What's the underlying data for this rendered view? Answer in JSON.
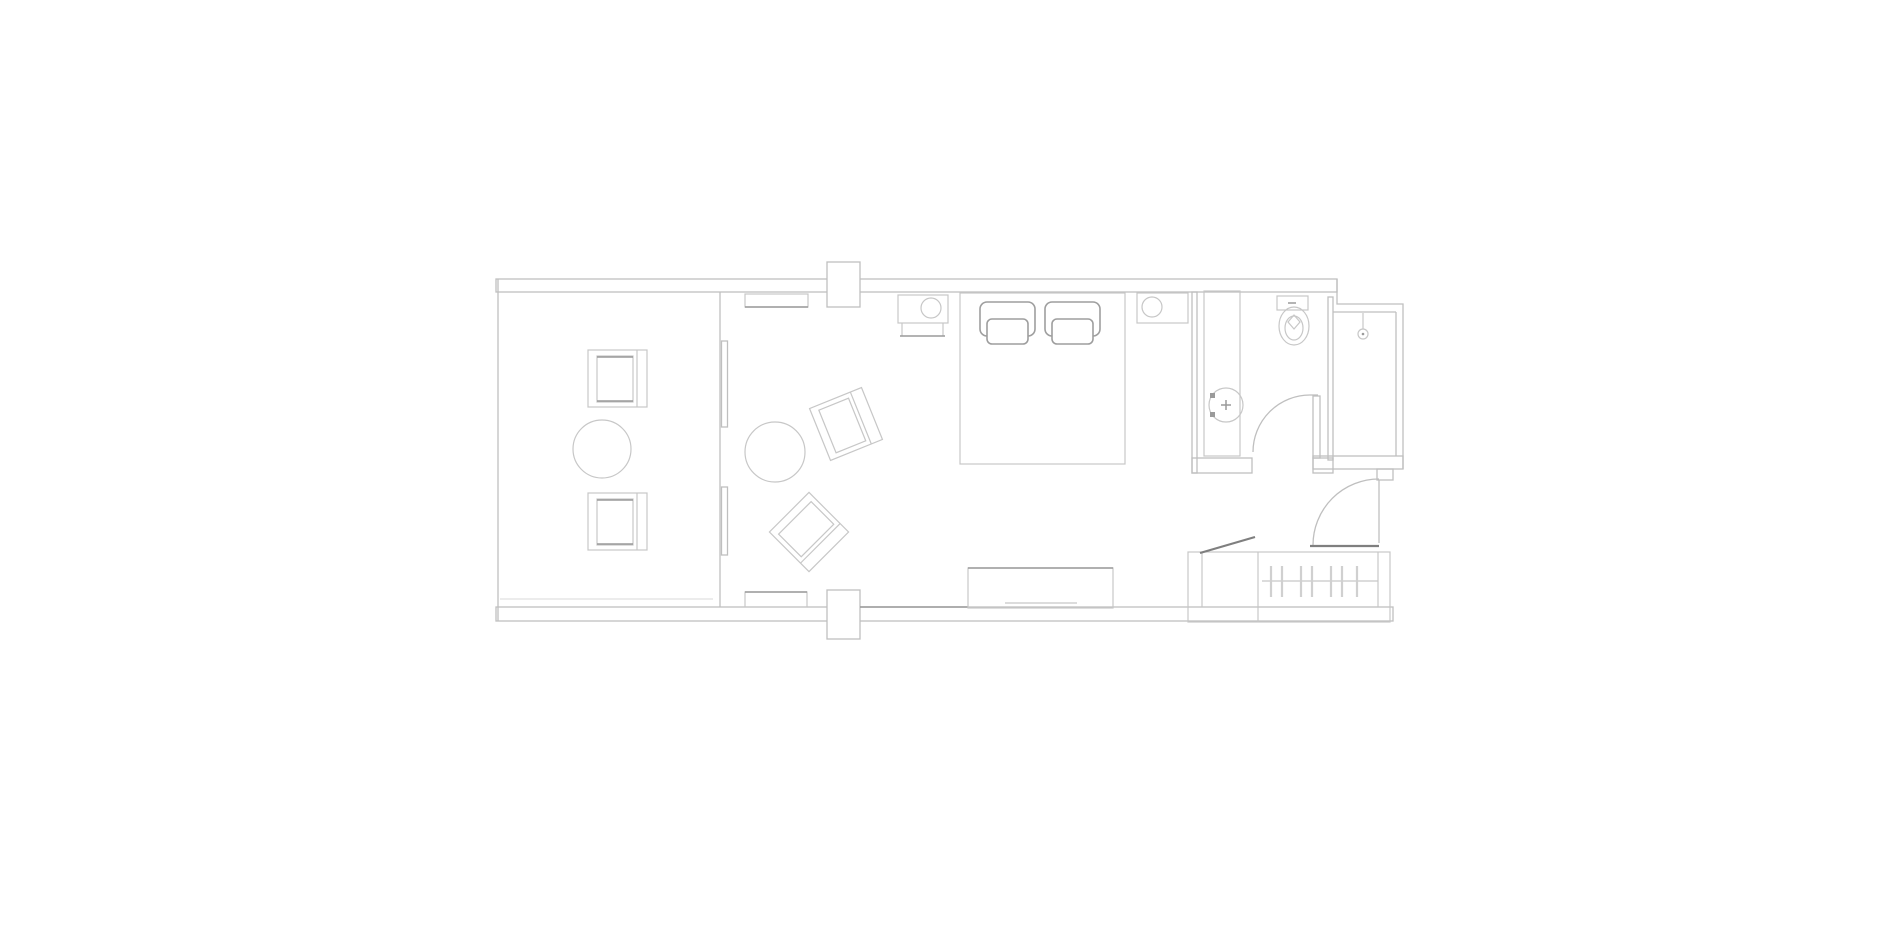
{
  "colors": {
    "background": "#ffffff",
    "wall_line": "#bfbfbf",
    "furniture_line": "#c7c7c7",
    "pillow_line": "#9e9e9e",
    "accent_line": "#7f7f7f",
    "accent_mid_line": "#9a9a9a",
    "hanger_line": "#d0d0d0",
    "faint_line": "#dadada"
  },
  "plan": {
    "type": "floor-plan",
    "rooms": [
      "balcony",
      "bedroom",
      "bathroom-wc",
      "shower-room",
      "entry-hall",
      "wardrobe"
    ],
    "fixtures": [
      "balcony-armchair",
      "balcony-armchair",
      "balcony-round-table",
      "sliding-glass-door",
      "lounge-chair",
      "lounge-chair",
      "round-side-table",
      "wall-console",
      "wall-console",
      "structural-column",
      "structural-column",
      "nightstand-with-lamp",
      "nightstand-with-lamp",
      "stool",
      "double-bed",
      "pillow",
      "pillow",
      "tv-console",
      "vanity-counter",
      "round-wash-basin",
      "toilet",
      "shower-head",
      "bathroom-door-swing",
      "entry-door-swing",
      "wardrobe-rail-with-hangers",
      "luggage-rack"
    ]
  }
}
